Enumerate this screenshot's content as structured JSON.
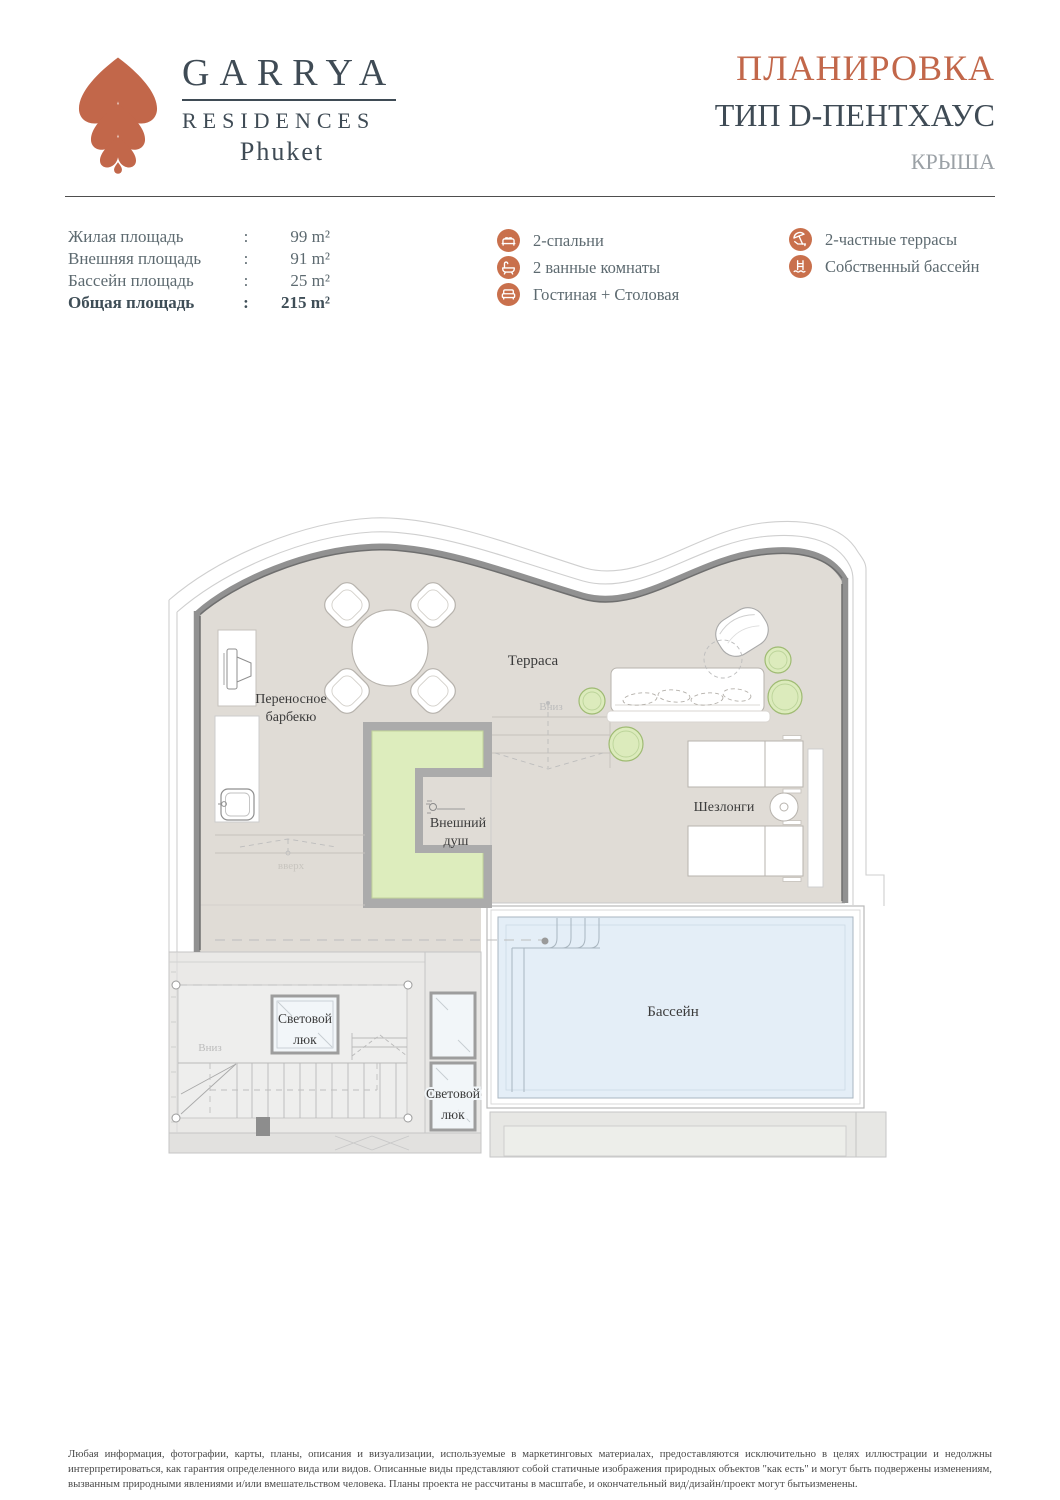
{
  "colors": {
    "accent": "#c2674a",
    "slate": "#3f4b55",
    "muted_gray": "#9ba1a6",
    "pool_blue": "#e4eef7",
    "plan_green": "#ddedbd",
    "floor_beige": "#e0dcd6",
    "wall_gray": "#919191"
  },
  "logo": {
    "brand": "GARRYA",
    "subtitle": "RESIDENCES",
    "location": "Phuket"
  },
  "title": {
    "heading": "ПЛАНИРОВКА",
    "type": "ТИП D-ПЕНТХАУС",
    "level": "КРЫША"
  },
  "areas": {
    "rows": [
      {
        "label": "Жилая площадь",
        "sep": ":",
        "value": "99 m²"
      },
      {
        "label": "Внешняя площадь",
        "sep": ":",
        "value": "91 m²"
      },
      {
        "label": "Бассейн площадь",
        "sep": ":",
        "value": "25 m²"
      },
      {
        "label": "Общая площадь",
        "sep": ":",
        "value": "215 m²"
      }
    ]
  },
  "features": {
    "left": [
      {
        "icon": "bed-icon",
        "label": "2-спальни"
      },
      {
        "icon": "bathtub-icon",
        "label": "2 ванные комнаты"
      },
      {
        "icon": "sofa-icon",
        "label": "Гостиная + Столовая"
      }
    ],
    "right": [
      {
        "icon": "sun-lounger-umbrella-icon",
        "label": "2-частные террасы"
      },
      {
        "icon": "pool-ladder-icon",
        "label": "Собственный бассейн"
      }
    ]
  },
  "plan": {
    "labels": {
      "terrace": "Терраса",
      "bbq_line1": "Переносное",
      "bbq_line2": "барбекю",
      "shower_line1": "Внешний",
      "shower_line2": "душ",
      "loungers": "Шезлонги",
      "pool": "Бассейн",
      "skylight_line1": "Световой",
      "skylight_line2": "люк",
      "down": "Вниз",
      "up": "вверх"
    }
  },
  "disclaimer": {
    "text": "Любая информация, фотографии, карты, планы, описания и визуализации, используемые в маркетинговых материалах, предоставляются исключительно в целях иллюстрации и недолжны интерпретироваться, как гарантия определенного вида или видов. Описанные виды представляют собой статичные изображения природных объектов \"как есть\" и могут быть подвержены изменениям, вызванным природными явлениями и/или вмешательством человека. Планы проекта не рассчитаны в масштабе, и окончательный вид/дизайн/проект могут бытьизменены."
  }
}
